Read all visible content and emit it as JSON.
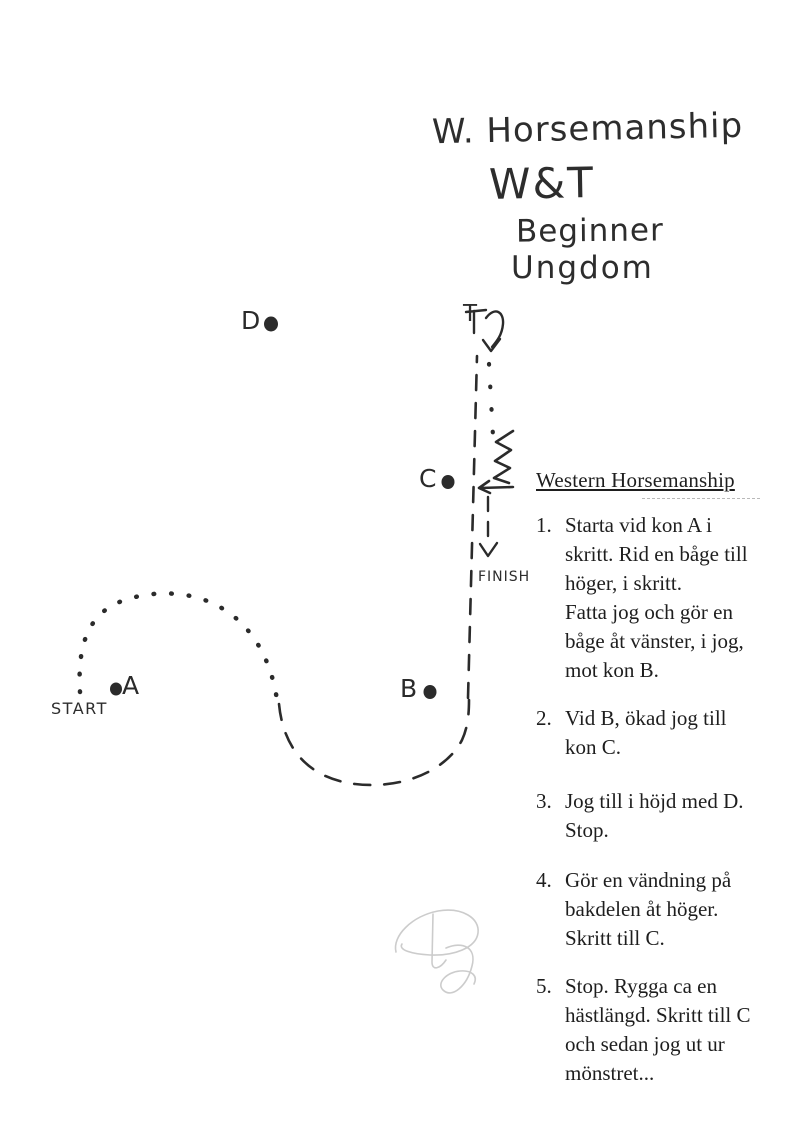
{
  "title_block": {
    "line1": "W. Horsemanship",
    "line2": "W&T",
    "line3": "Beginner",
    "line4": "Ungdom"
  },
  "pattern": {
    "cone_a": "A",
    "cone_b": "B",
    "cone_c": "C",
    "cone_d": "D",
    "turn_marker": "T",
    "start_label": "START",
    "finish_label": "FINISH",
    "gait_legend": {
      "dotted_line": "skritt (walk)",
      "dashed_line": "jog",
      "zigzag": "rygga (back up)",
      "curl_arrow": "vändning (turn)"
    }
  },
  "instructions": {
    "heading": "Western Horsemanship",
    "items": [
      {
        "number": "1.",
        "lines": [
          "Starta vid kon A i",
          "skritt. Rid en båge till",
          "höger, i skritt.",
          "Fatta jog och gör en",
          "båge åt vänster, i jog,",
          "mot kon B."
        ]
      },
      {
        "number": "2.",
        "lines": [
          "Vid B, ökad jog till",
          "kon C."
        ]
      },
      {
        "number": "3.",
        "lines": [
          "Jog till i höjd med D.",
          "Stop."
        ]
      },
      {
        "number": "4.",
        "lines": [
          "Gör en vändning på",
          "bakdelen åt höger.",
          "Skritt till C."
        ]
      },
      {
        "number": "5.",
        "lines": [
          "Stop. Rygga ca en",
          "hästlängd. Skritt till C",
          "och sedan jog ut ur",
          "mönstret..."
        ]
      }
    ]
  },
  "colors": {
    "paper": "#ffffff",
    "ink": "#2b2b2b",
    "typed_text": "#1e1e1e",
    "pencil": "#cccccc"
  }
}
